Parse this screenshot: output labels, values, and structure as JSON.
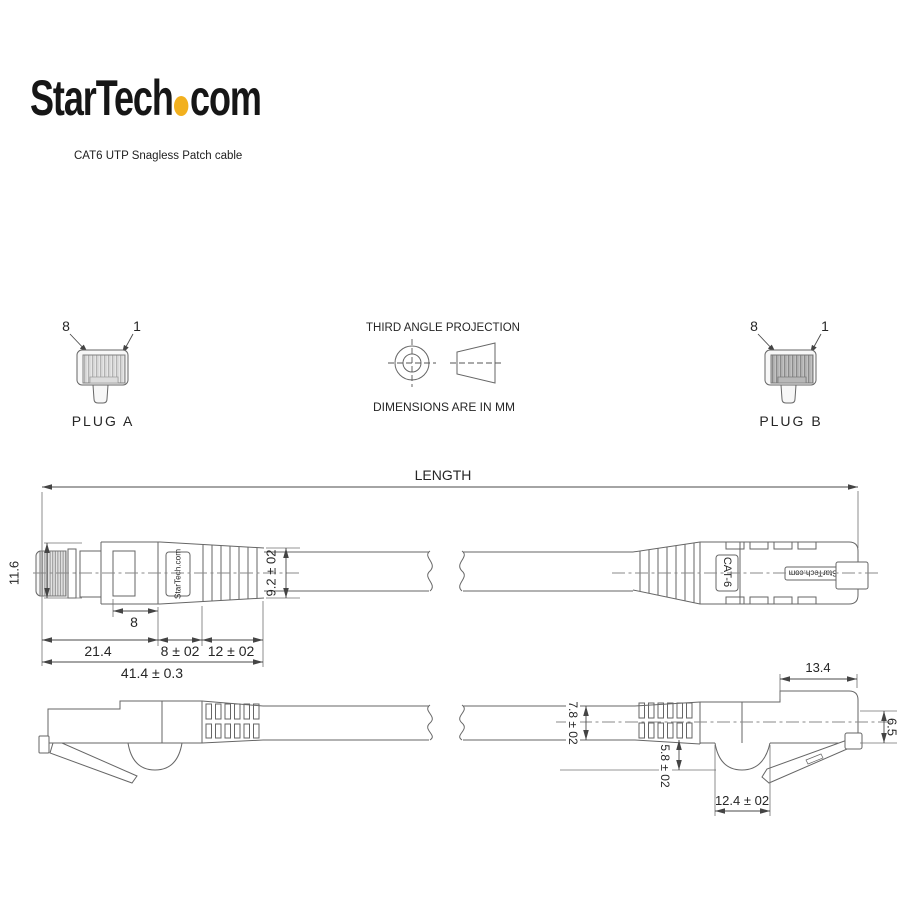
{
  "brand": {
    "logo_text_1": "StarTech",
    "logo_text_2": "com",
    "dot_color": "#F2B01E",
    "subtitle": "CAT6 UTP Snagless Patch cable"
  },
  "plugs": {
    "plug_a": {
      "label": "PLUG A",
      "pin_first": "8",
      "pin_last": "1"
    },
    "plug_b": {
      "label": "PLUG B",
      "pin_first": "8",
      "pin_last": "1"
    }
  },
  "projection": {
    "title": "THIRD ANGLE PROJECTION",
    "units": "DIMENSIONS ARE IN MM"
  },
  "top_view": {
    "length_label": "LENGTH",
    "plug_height": "11.6",
    "contact_window_width": "8",
    "plug_body_length": "21.4",
    "boot_length": "8 ± 02",
    "strain_relief_length": "12 ± 02",
    "overall_connector_length": "41.4 ± 0.3",
    "boot_diameter": "9.2 ± 02",
    "boot_marking": "StarTech.com",
    "cable_marking": "CAT-6",
    "badge_marking": "StarTech.com"
  },
  "side_view": {
    "cable_diameter": "7.8 ± 02",
    "boot_fin_height": "5.8 ± 02",
    "boot_fin_width": "12.4 ± 02",
    "plug_front_length": "13.4",
    "plug_front_height": "6.5"
  }
}
